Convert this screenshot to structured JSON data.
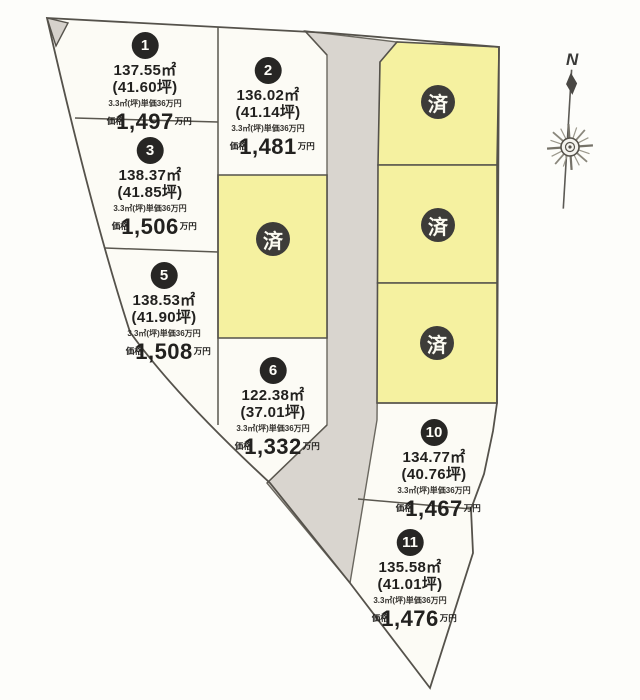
{
  "map": {
    "title": "land-subdivision-plan",
    "compass_label": "N",
    "sold_label": "済",
    "colors": {
      "available_fill": "#fcfbf5",
      "sold_fill": "#f5f1a0",
      "road_fill": "#d9d5cf",
      "boundary_line": "#55524b",
      "badge_dark": "#3d3c39"
    },
    "plots": [
      {
        "number": "1",
        "area": "137.55㎡",
        "tsubo": "(41.60坪)",
        "unit": "3.3㎡(坪)単価36万円",
        "price_prefix": "価格",
        "price": "1,497",
        "price_suffix": "万円"
      },
      {
        "number": "2",
        "area": "136.02㎡",
        "tsubo": "(41.14坪)",
        "unit": "3.3㎡(坪)単価36万円",
        "price_prefix": "価格",
        "price": "1,481",
        "price_suffix": "万円"
      },
      {
        "number": "3",
        "area": "138.37㎡",
        "tsubo": "(41.85坪)",
        "unit": "3.3㎡(坪)単価36万円",
        "price_prefix": "価格",
        "price": "1,506",
        "price_suffix": "万円"
      },
      {
        "number": "5",
        "area": "138.53㎡",
        "tsubo": "(41.90坪)",
        "unit": "3.3㎡(坪)単価36万円",
        "price_prefix": "価格",
        "price": "1,508",
        "price_suffix": "万円"
      },
      {
        "number": "6",
        "area": "122.38㎡",
        "tsubo": "(37.01坪)",
        "unit": "3.3㎡(坪)単価36万円",
        "price_prefix": "価格",
        "price": "1,332",
        "price_suffix": "万円"
      },
      {
        "number": "10",
        "area": "134.77㎡",
        "tsubo": "(40.76坪)",
        "unit": "3.3㎡(坪)単価36万円",
        "price_prefix": "価格",
        "price": "1,467",
        "price_suffix": "万円"
      },
      {
        "number": "11",
        "area": "135.58㎡",
        "tsubo": "(41.01坪)",
        "unit": "3.3㎡(坪)単価36万円",
        "price_prefix": "価格",
        "price": "1,476",
        "price_suffix": "万円"
      }
    ],
    "sold_plots": [
      {
        "position": "center"
      },
      {
        "position": "right-top"
      },
      {
        "position": "right-middle"
      },
      {
        "position": "right-bottom"
      }
    ]
  }
}
